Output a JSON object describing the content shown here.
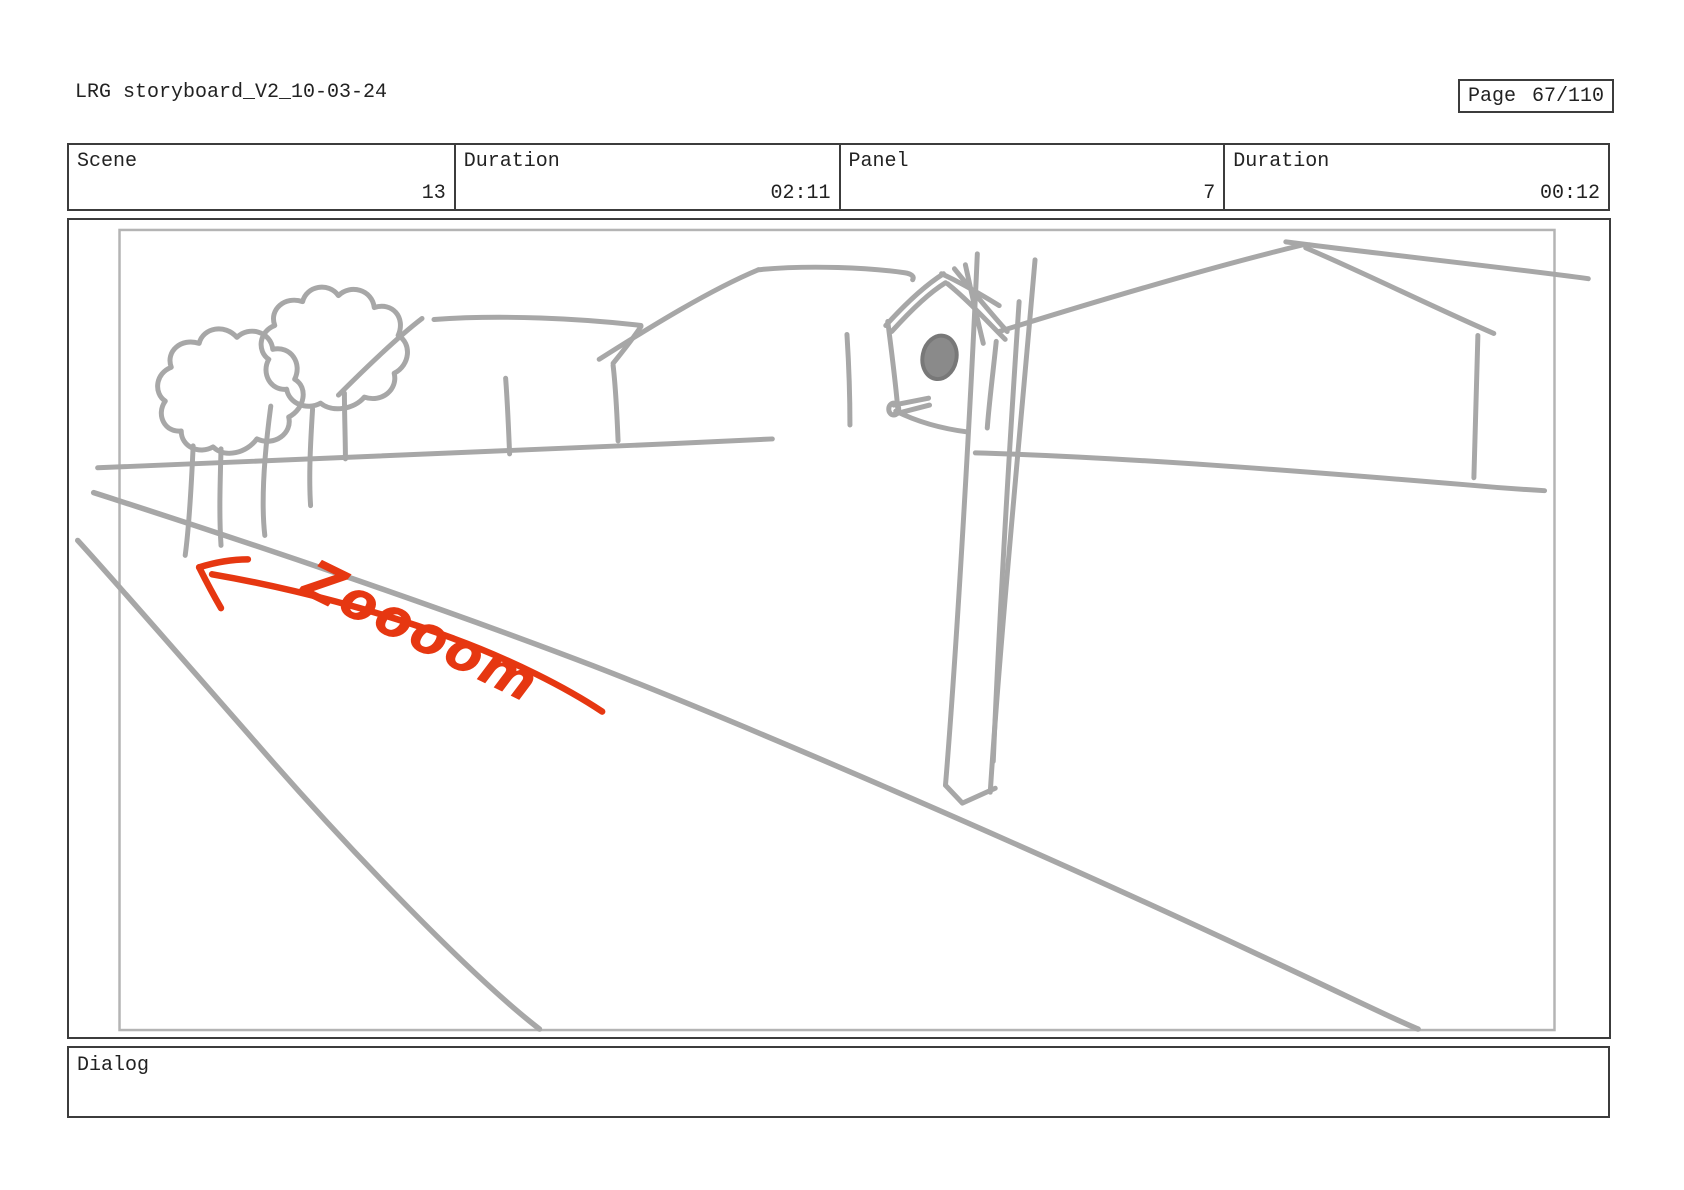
{
  "header": {
    "title": "LRG storyboard_V2_10-03-24",
    "page_box": {
      "label": "Page",
      "value": "67/110"
    }
  },
  "info_table": {
    "cells": [
      {
        "label": "Scene",
        "value": "13"
      },
      {
        "label": "Duration",
        "value": "02:11"
      },
      {
        "label": "Panel",
        "value": "7"
      },
      {
        "label": "Duration",
        "value": "00:12"
      }
    ]
  },
  "sketch": {
    "annotation": "Zoooom",
    "colors": {
      "line": "#a7a7a7",
      "accent": "#e63711",
      "frame": "#b4b4b4"
    },
    "elements": [
      "two-trees",
      "house-rooflines",
      "birdhouse-on-post",
      "ground-line",
      "receding-road",
      "zoom-arrow"
    ]
  },
  "dialog": {
    "label": "Dialog"
  }
}
